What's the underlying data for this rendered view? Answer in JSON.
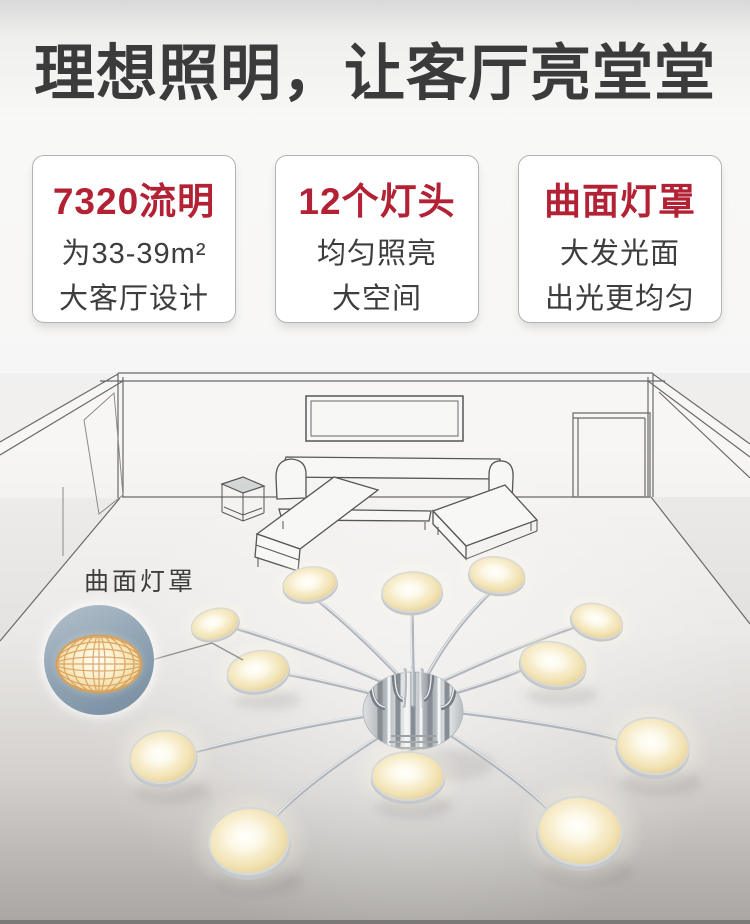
{
  "header": {
    "title": "理想照明，让客厅亮堂堂"
  },
  "features": [
    {
      "title": "7320流明",
      "line1": "为33-39m²",
      "line2": "大客厅设计"
    },
    {
      "title": "12个灯头",
      "line1": "均匀照亮",
      "line2": "大空间"
    },
    {
      "title": "曲面灯罩",
      "line1": "大发光面",
      "line2": "出光更均匀"
    }
  ],
  "scene": {
    "callout_label": "曲面灯罩",
    "lamp": {
      "head_count": 12,
      "style": "chrome-arms-radial-ceiling-lamp"
    },
    "room": {
      "items": [
        "tv",
        "sectional-sofa",
        "side-table",
        "door"
      ]
    }
  },
  "colors": {
    "accent_red": "#b32134",
    "headline_text": "#3b3b3b",
    "body_text": "#3d3d3d",
    "callout_circle_blue": "#8ca1b3",
    "lamp_glow_warm": "#f3e4b6",
    "wireframe_line": "#5f5f5f"
  }
}
